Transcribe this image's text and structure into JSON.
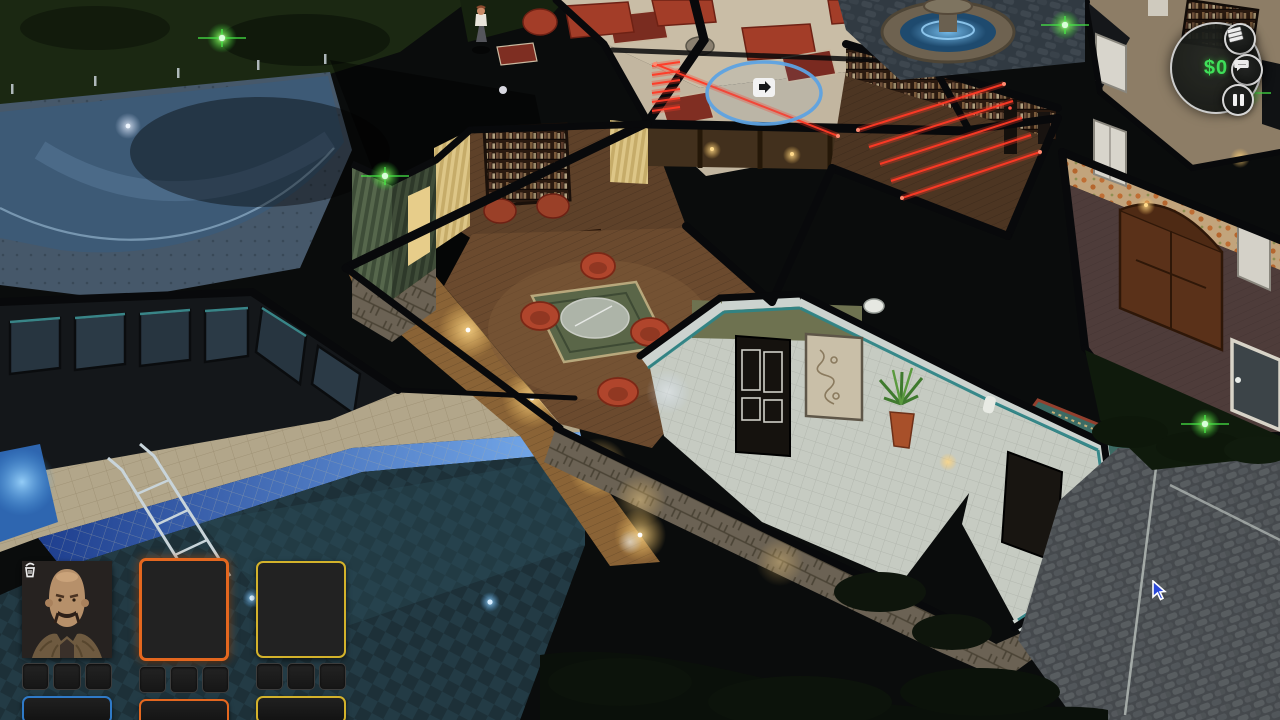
{
  "hud": {
    "money": {
      "label": "$0",
      "color": "#3fe05a"
    },
    "buttons": [
      {
        "name": "loot-log",
        "icon": "money-stack-icon"
      },
      {
        "name": "messages",
        "icon": "chat-bubble-icon"
      },
      {
        "name": "pause",
        "icon": "pause-icon"
      }
    ]
  },
  "party": {
    "drop_button_icon": "trash-bin-icon",
    "members": [
      {
        "id": "hippie",
        "portrait": "long-haired bearded man with round orange glasses",
        "accent": "#2f7ac8",
        "selected": false,
        "inventory_slots": 3
      },
      {
        "id": "afro-woman",
        "portrait": "woman with afro, yellow headband, shell necklace",
        "accent": "#e4671f",
        "selected": true,
        "inventory_slots": 3
      },
      {
        "id": "bald-man",
        "portrait": "bald man with moustache and fur coat",
        "accent": "#d3b22b",
        "selected": false,
        "inventory_slots": 3
      }
    ]
  },
  "scene": {
    "objective_marker": {
      "icon": "exit-icon",
      "ring_color": "#5da2e2",
      "x": 764,
      "y": 93
    },
    "laser_color": "#ff3a26",
    "sparkle_color": "#46e846",
    "sparkles": [
      [
        222,
        38
      ],
      [
        385,
        176
      ],
      [
        1065,
        25
      ],
      [
        1247,
        93
      ],
      [
        1205,
        424
      ]
    ],
    "cursor": {
      "x": 1152,
      "y": 580
    }
  }
}
